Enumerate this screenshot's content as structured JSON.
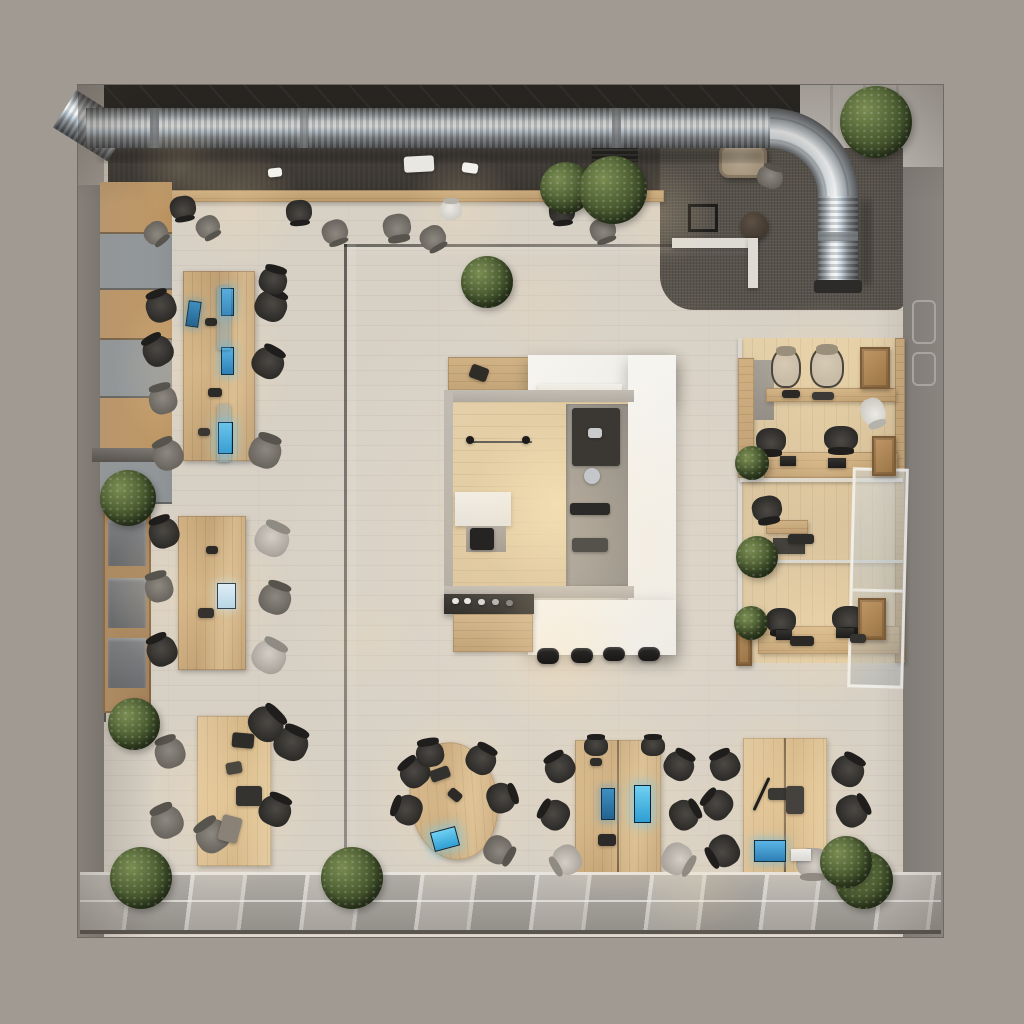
{
  "scene": {
    "type": "photorealistic top-down 3D render of an open-plan office loft",
    "description": "Bird's-eye view of a square office interior on a warm gray backdrop. A corrugated silver HVAC duct runs along the dark ceiling band at the top and elbows down near the top-right into a dark carpeted lounge with a tan armchair, black side table and corner plant. The center holds a white-roofed coffee/kitchen island with wood interior, espresso equipment, a black bar counter and four stools. Left wall has wood/gray locker panels and an open shelf with gray bins. Three long wooden bench desks with dark office chairs and glowing blue monitors run down the left side; three more desk clusters line the bottom; three cubicle bays with wooden desks, crates and plants fill the right side behind a glass door. Glass partitions cross the floor and the bottom wall is a band of glazed panels. A dozen potted plants and warm ceiling light pools complete the scene.",
    "areas": [
      "ceiling-duct-zone",
      "top-counter-bar",
      "lounge-corner",
      "left-locker-wall",
      "left-desk-column",
      "central-coffee-island",
      "right-cubicle-bays",
      "bottom-desk-row",
      "glass-partitions",
      "bottom-glazed-wall"
    ],
    "object_counts": {
      "hvac-duct": 1,
      "office-chairs": 46,
      "bar-stools": 4,
      "potted-plants": 13,
      "desk-clusters": 7,
      "cubicle-bays": 3,
      "glowing-monitors": 8,
      "locker-panels": 6,
      "storage-bins": 3,
      "wooden-crates": 4,
      "glass-doors": 1,
      "armchairs": 1,
      "side-tables": 2
    }
  },
  "palette": {
    "backdrop": "#a19a93",
    "floor": "#d7d0c5",
    "floor-lit": "#efe7d8",
    "wood": "#c9a97b",
    "wood-light": "#dcc49c",
    "wood-dark": "#a5835a",
    "white": "#f2f1ed",
    "wall-gray": "#8f8b85",
    "panel-gray": "#9ba0a3",
    "carpet": "#57524b",
    "ceiling": "#201f1d",
    "chair": "#2e2c29",
    "chair-mid": "#4c4945",
    "beige": "#c9bca6",
    "duct-hi": "#f4f6f7",
    "duct-mid": "#b7bcc0",
    "duct-dark": "#54575a",
    "duct-blue": "#c3d2de",
    "plant-dark": "#2c3a1f",
    "plant-mid": "#47582e",
    "plant-light": "#7a8d52",
    "screen": "#45a7dd",
    "screen-deep": "#2d7fb5",
    "warm": "rgba(255,226,176,0.55)",
    "glass": "#c9d2d4",
    "black": "#191817"
  }
}
